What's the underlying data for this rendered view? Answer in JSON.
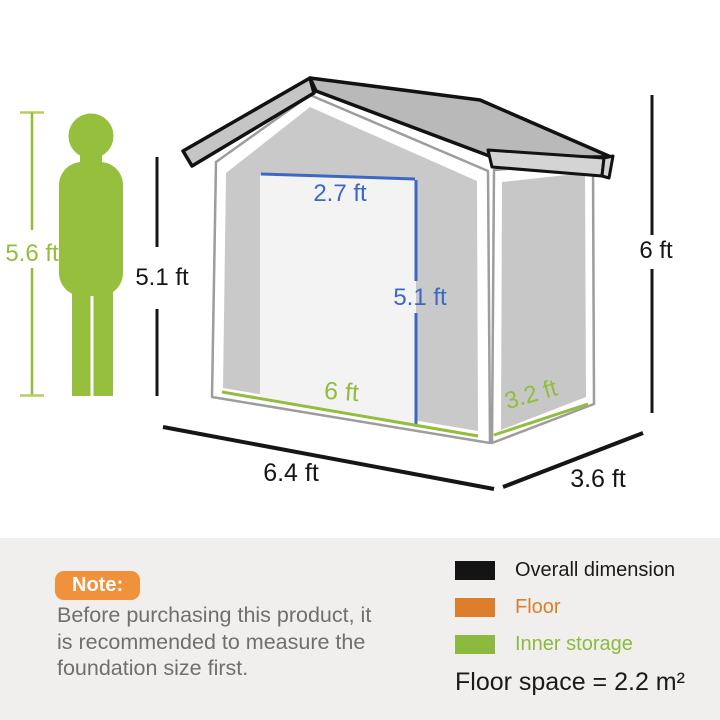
{
  "diagram": {
    "person_height_label": "5.6 ft",
    "wall_height_label": "5.1 ft",
    "door_width_label": "2.7 ft",
    "door_height_label": "5.1 ft",
    "overall_height_label": "6 ft",
    "inner_width_label": "6 ft",
    "inner_depth_label": "3.2 ft",
    "overall_width_label": "6.4 ft",
    "overall_depth_label": "3.6 ft"
  },
  "note": {
    "badge_label": "Note:",
    "lines": [
      "Before purchasing this product, it",
      "is recommended to measure the",
      "foundation size first."
    ]
  },
  "legend": {
    "items": [
      {
        "label": "Overall dimension",
        "color": "#141414"
      },
      {
        "label": "Floor",
        "color": "#dd7e2d"
      },
      {
        "label": "Inner storage",
        "color": "#8cba41"
      }
    ],
    "floor_space_label": "Floor space = 2.2 m²"
  },
  "colors": {
    "measure_green": "#93bd3d",
    "measure_cap_green": "#bccd5f",
    "measure_blue": "#3b68c5",
    "measure_black": "#161616",
    "person_green": "#97bf3e",
    "note_badge_orange": "#f0913c",
    "note_text_gray": "#6f6f6f",
    "panel_background": "#f1efed",
    "wall_gray": "#c9c9c9",
    "roof_gray": "#b9b9b9",
    "door_light": "#f3f3f3"
  }
}
